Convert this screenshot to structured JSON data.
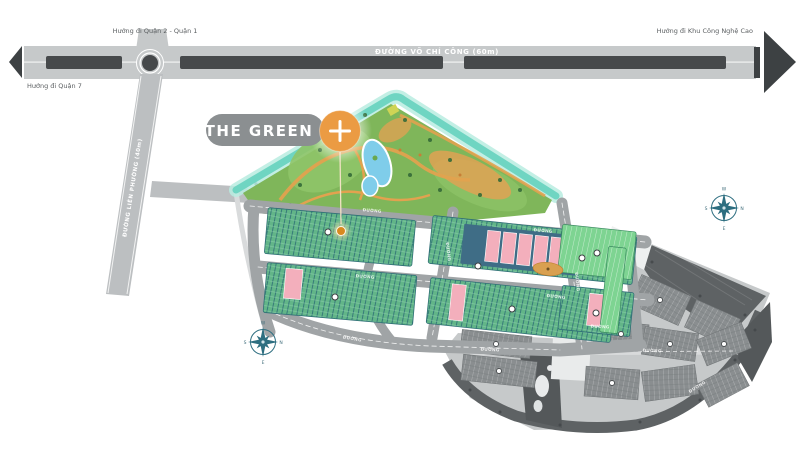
{
  "map": {
    "project": {
      "title": "THE GREEN",
      "marker_symbol": "+"
    },
    "roads": {
      "main_road_label": "ĐƯỜNG VÕ CHÍ CÔNG (60m)",
      "side_road_label": "ĐƯỜNG LIÊN PHƯỜNG (40m)",
      "internal_street_label": "ĐƯỜNG"
    },
    "directions": {
      "top": "Hướng đi Quận 2 - Quận 1",
      "left": "Hướng đi Quận 7",
      "right": "Hướng đi Khu Công Nghệ Cao"
    },
    "compass": {
      "top": "W",
      "right": "N",
      "bottom": "E",
      "left": "S"
    },
    "colors": {
      "accent_orange": "#eb9b43",
      "badge_gray": "#8b8f91",
      "park_green": "#7fb65a",
      "block_green": "#62b588",
      "bright_green": "#7ed492",
      "pink_building": "#f3afbc",
      "canal_teal": "#6fd5c2",
      "pool_blue": "#7fcdea",
      "road_gray": "#a0a4a6",
      "highway_dark": "#46494b",
      "phase2_dark": "#5e6264",
      "compass_teal": "#2d6e80"
    }
  }
}
